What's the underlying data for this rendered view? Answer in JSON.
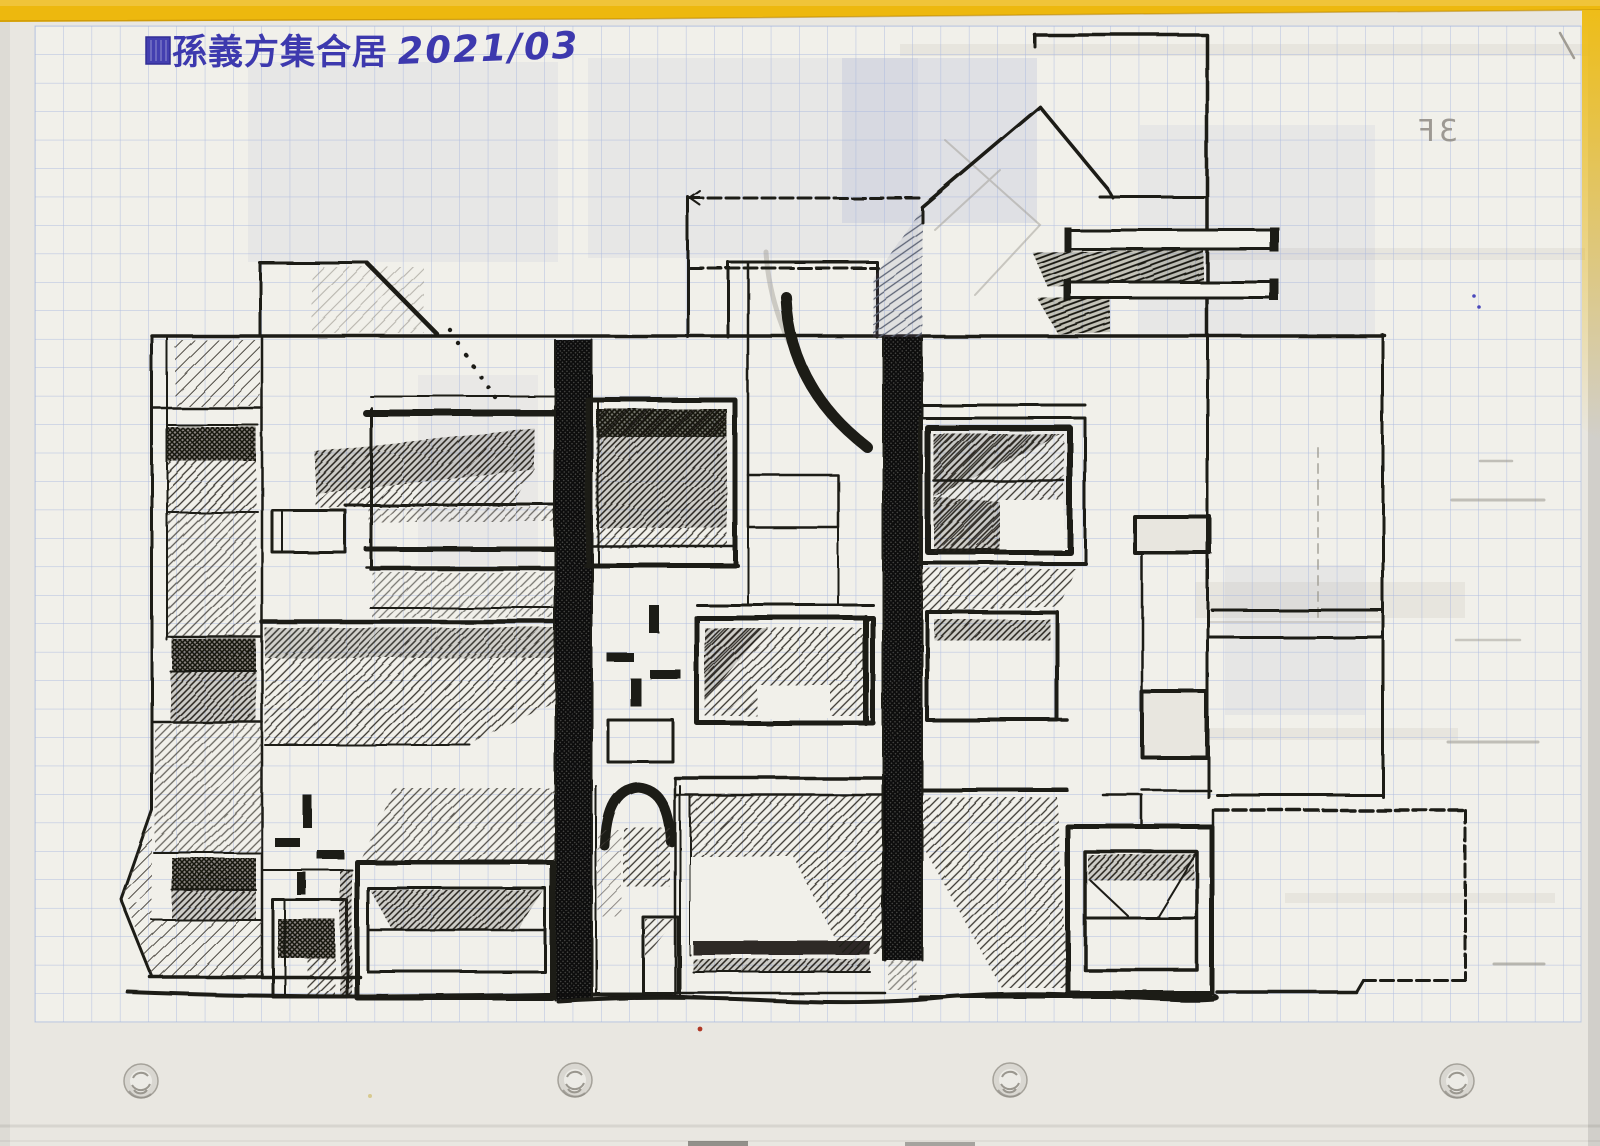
{
  "document": {
    "kind": "scanned grid-paper notebook page with hand-drawn architectural elevation sketch",
    "title_cjk": "孫義方集合居",
    "date": "2021/03",
    "mirrored_note": "3F",
    "punch_hole_count": 4
  },
  "colors": {
    "folder_yellow": "#ecb312",
    "paper": "#efeee8",
    "grid_blue": "#a6b5de",
    "ink": "#1c1a16",
    "pen_blue": "#3d39ae",
    "pencil_grey": "#8f8b84"
  }
}
